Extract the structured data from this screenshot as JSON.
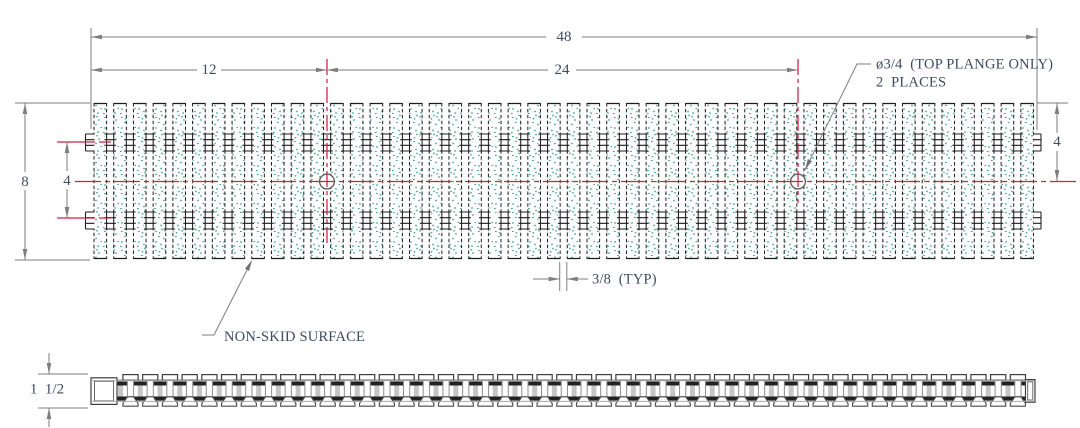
{
  "drawing": {
    "type": "engineering-drawing",
    "views": {
      "plan": {
        "bar_count": 48,
        "crossrod_rows": 2,
        "hole_count": 2,
        "labels": {
          "overall_width": "48",
          "left_edge_to_first_hole": "12",
          "hole_to_hole": "24",
          "overall_depth": "8",
          "crossrod_row_spacing": "4",
          "top_edge_to_centerline": "4",
          "bar_gap": "3/8  (TYP)",
          "hole_callout_line1": "ø3/4  (TOP PLANGE ONLY)",
          "hole_callout_line2": "2  PLACES",
          "surface_note": "NON-SKID SURFACE"
        }
      },
      "side": {
        "i_bar_count": 46,
        "labels": {
          "thickness": "1  1/2"
        }
      }
    },
    "colors": {
      "centerline_red": "#cf2140",
      "stipple_green": "#3ca387",
      "dimension_gray": "#7e7e7e",
      "annotation_text": "#3e4a5e",
      "edge_dark": "#1c1c1c",
      "steel_gray": "#8d8d8d"
    }
  }
}
